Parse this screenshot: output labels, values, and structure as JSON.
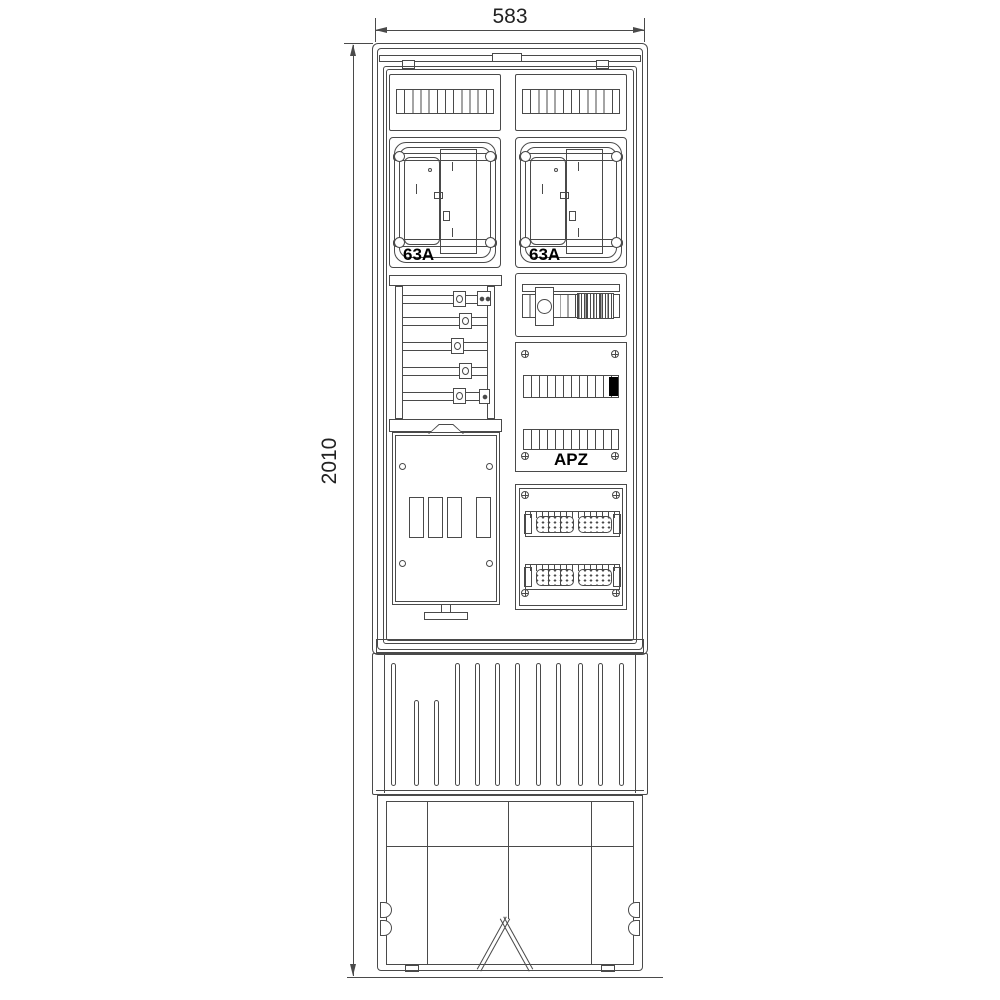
{
  "drawing": {
    "dimensions": {
      "width_label": "583",
      "height_label": "2010"
    },
    "meter_field_left": {
      "rating_label": "63A"
    },
    "meter_field_right": {
      "rating_label": "63A"
    },
    "apz_field": {
      "label": "APZ"
    },
    "colors": {
      "line": "#4a4a4a",
      "label_text": "#000000",
      "filled_module": "#000000",
      "background": "#ffffff"
    }
  }
}
